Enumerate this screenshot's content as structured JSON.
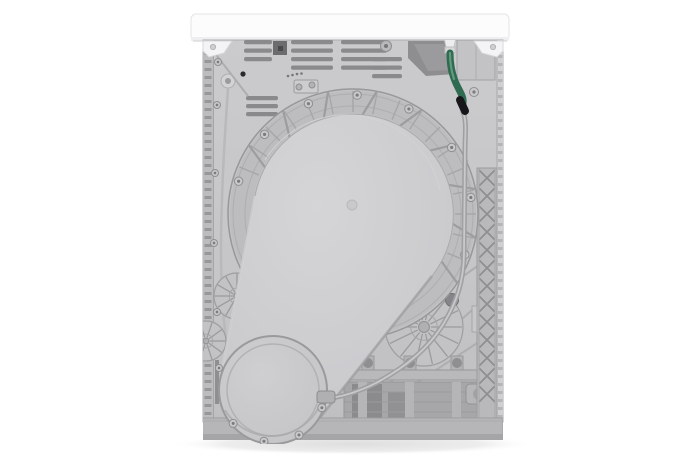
{
  "scene": {
    "type": "product-photo",
    "subject": "rear-view-of-freestanding-tumble-dryer",
    "background_color": "#ffffff"
  },
  "colors": {
    "background": "#ffffff",
    "top_panel": "#fcfcfd",
    "top_panel_edge": "#dcdcde",
    "rear_panel": "#c7c7c9",
    "rear_panel_dark": "#bdbdbf",
    "drum_dome": "#cdcdcf",
    "drum_dome_light": "#d6d6d8",
    "drum_ring": "#c2c2c4",
    "rib_line": "#a6a6a8",
    "base_plate": "#b6b6b8",
    "base_plate_edge": "#9e9ea0",
    "vent_slot": "#8a8a8d",
    "vent_box_dark": "#6c6c6f",
    "dark_opening": "#8e8e91",
    "recess": "#a7a7a9",
    "recess_dark": "#8b8b8e",
    "lattice": "#b9b9bb",
    "lattice_line": "#8f8f92",
    "inlet_hose_green": "#2e6b50",
    "inlet_hose_highlight": "#639a7e",
    "hose_tip_black": "#17171b",
    "drain_hose": "#a3a3a5",
    "drain_hose_core": "#c9c9cb",
    "wire": "#b9b9bb",
    "screw": "#9a9a9d",
    "bolt_dark": "#85858a",
    "shadow": "#e3e3e5",
    "bracket_white": "#f4f4f6"
  },
  "components": {
    "top_panel": "worktop lid",
    "corner_bracket_left": "top-left transport bracket",
    "corner_bracket_right": "top-right transport bracket",
    "rear_panel": "rear sheet-metal panel",
    "vent_slots": "ventilation slots",
    "vent_box": "small vent cutout",
    "dark_opening": "angled service opening",
    "cord_box": "power-cord housing",
    "inlet_hose": "green inlet hose with clamp",
    "drain_hose": "gray drain hose",
    "drum_back": "drum rear bulge (teardrop)",
    "drum_ring": "ribbed drum flange with screws",
    "blower_housing": "round blower / pump cover",
    "wheel_left": "stamped reinforcement star (left)",
    "wheel_right": "stamped reinforcement star (right)",
    "lattice_strip": "cross-hatched stiffener strip",
    "rail": "lower mounting rail with bolts",
    "recess": "dark recessed lower panel",
    "base_plate": "plinth / base plate",
    "cable": "wire routed along left side",
    "shadow": "floor shadow"
  }
}
